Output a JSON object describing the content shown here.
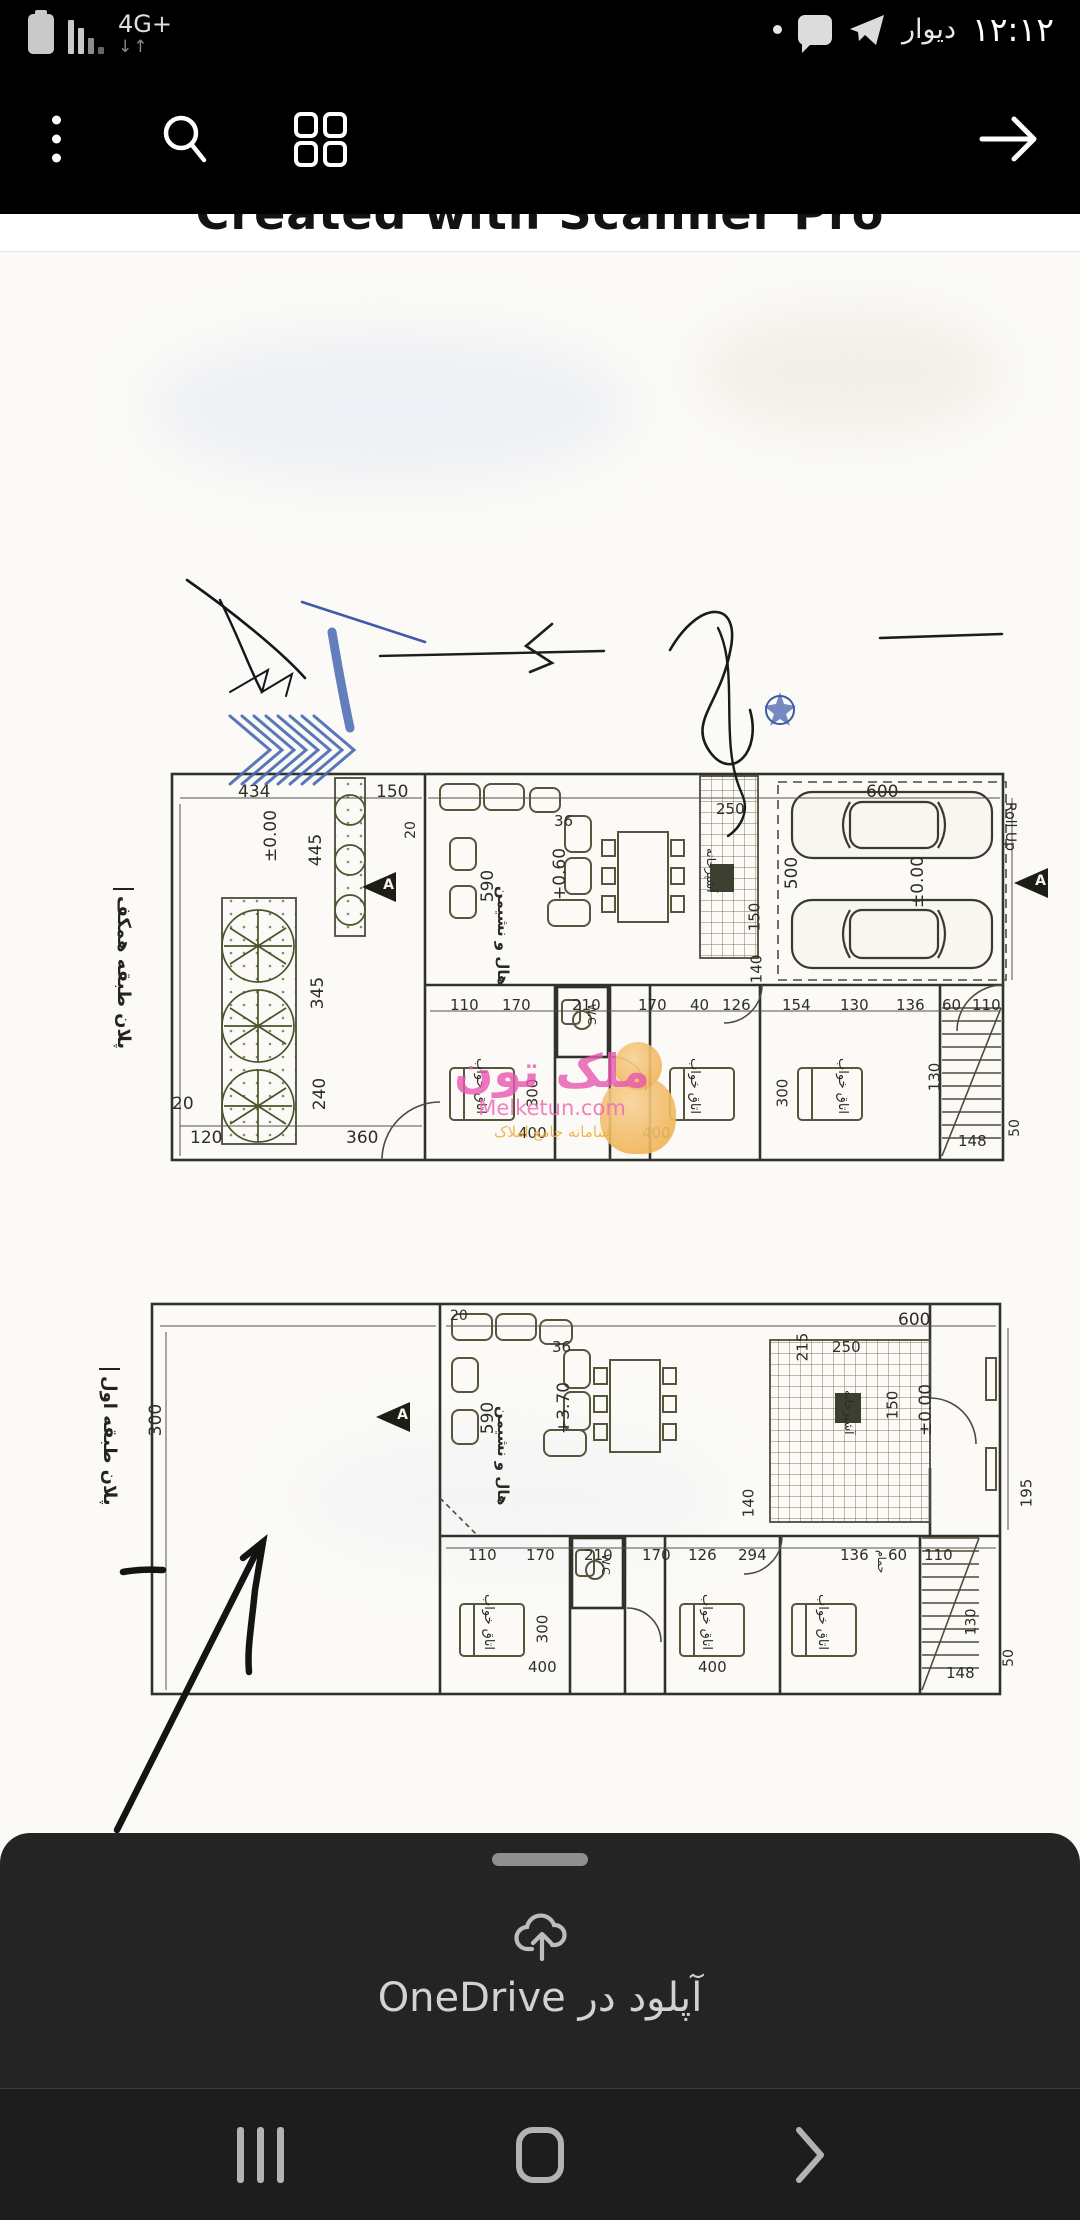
{
  "status_bar": {
    "network": "4G+",
    "app_name": "دیوار",
    "time": "۱۲:۱۲"
  },
  "banner": {
    "text": "Created with Scanner Pro"
  },
  "title_block": {
    "logo": "ArTak",
    "logo_sub": "architect",
    "owner_col": "نام مالک : آقای هاشم ایزدی",
    "phone_col": "شماره همراه مالک : ۰۹۱۵۲۲۲۱۲۶۴",
    "code_col": "کد نوسازی : ۲-۱۳-۳۶-۷",
    "sheet_info_col": "اطلاعات نقشه",
    "usage_col": "کاربری قطعه",
    "field_cols": [
      "طبقه",
      "نوع استفاده",
      "متراژ",
      "تعداد واحد",
      "نوع اسکلت",
      "نوع سند",
      "سطح کل متراژ"
    ],
    "scale_col": "مقیاس",
    "eng_info_col": "اطلاعات مهندسین",
    "engineer_cols": [
      "طراح نقشه",
      "طراح معماری",
      "محاسب سازه",
      "ناظر سازه",
      "ناظر مکانیک",
      "ناظر برق",
      "ناظر معماری",
      "طراح سازه"
    ],
    "notes_col": "توضیحات :",
    "serial_col": "شماره مسلسل",
    "send_col": "تاریخ ارسال نقشه"
  },
  "stamps": {
    "circle_logo": "ArTak",
    "office_number": "۶۹۰",
    "office_label": "دفتر فنی مهندسی",
    "manager_line1": "مدیر مسئول دفتر",
    "manager_line2": "حسن دماوندی",
    "engineer_line1": "مهندس حسن دماوندی",
    "engineer_line2": "۰۹۱۱۰۰۰۸۷۰",
    "engineer_line3": "۹۲۶۱",
    "date_note": "۱۴۰۲/۱/۲۶",
    "mid_line1": "۱۵۷۸۱",
    "mid_line2": "۸۱۶۷۰۰۰-۱۶۹۱"
  },
  "calc": {
    "total": "Σ = 425.20",
    "rows": [
      "= 14.90 ²",
      "= 136.90 ²",
      "= 136.90 ²",
      "= 63.60 ²",
      "= 73.30"
    ]
  },
  "watermark": {
    "title": "ملک تون",
    "domain": "Melketun.com",
    "subtitle": "سامانه جامع املاک"
  },
  "plan1": {
    "title": "پلان طبقه همکف",
    "levels": [
      "±0.00",
      "+0.60",
      "±0.00"
    ],
    "rooms": {
      "hall": "هال و نشیمن",
      "bedroom": "اتاق خواب",
      "wc": "W.C",
      "kitchen": "آشپزخانه",
      "rollup": "Roll Up",
      "section": "A"
    },
    "dims": [
      "434",
      "150",
      "445",
      "345",
      "240",
      "20",
      "120",
      "360",
      "590",
      "600",
      "500",
      "250",
      "150",
      "140",
      "130",
      "110",
      "170",
      "210",
      "170",
      "40",
      "126",
      "154",
      "130",
      "136",
      "60",
      "110",
      "300",
      "400",
      "400",
      "300",
      "148",
      "50",
      "36",
      "20"
    ]
  },
  "plan2": {
    "title": "پلان طبقه اول",
    "levels": [
      "+3.70",
      "±0.00"
    ],
    "rooms": {
      "hall": "هال و نشیمن",
      "bedroom": "اتاق خواب",
      "wc": "W.C",
      "kitchen": "آشپزخانه",
      "bath": "حمام",
      "section": "A"
    },
    "dims": [
      "20",
      "36",
      "250",
      "150",
      "215",
      "600",
      "590",
      "300",
      "195",
      "140",
      "110",
      "170",
      "210",
      "170",
      "294",
      "136",
      "60",
      "110",
      "300",
      "400",
      "400",
      "148",
      "50",
      "130",
      "126"
    ]
  },
  "bottom_sheet": {
    "action": "آپلود در OneDrive"
  }
}
